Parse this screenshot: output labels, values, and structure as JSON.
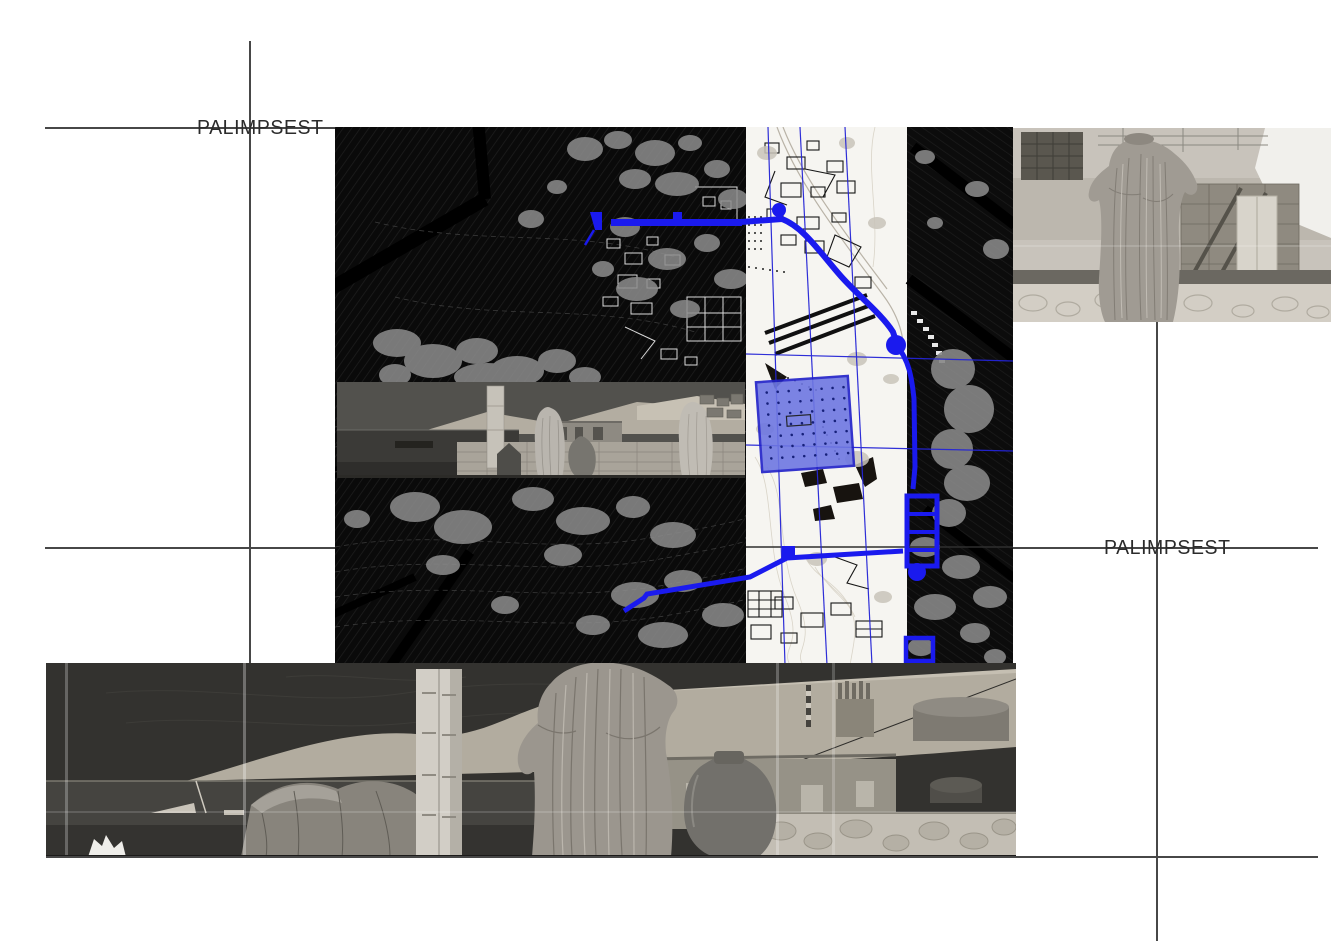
{
  "page": {
    "background_color": "#ffffff",
    "title_word": "PALIMPSEST"
  },
  "labels": {
    "palimpsest_left": "PALIMPSEST",
    "palimpsest_right": "PALIMPSEST"
  },
  "colors": {
    "route_blue": "#1a1aee",
    "square_fill": "#6e77e2",
    "square_border": "#2020c8",
    "thin_blue": "#2424d6",
    "crop_line": "#474747",
    "map_dark": "#0a0a0a",
    "plan_paper": "#f6f5f1",
    "blob_gray": "#8d8d8d"
  }
}
